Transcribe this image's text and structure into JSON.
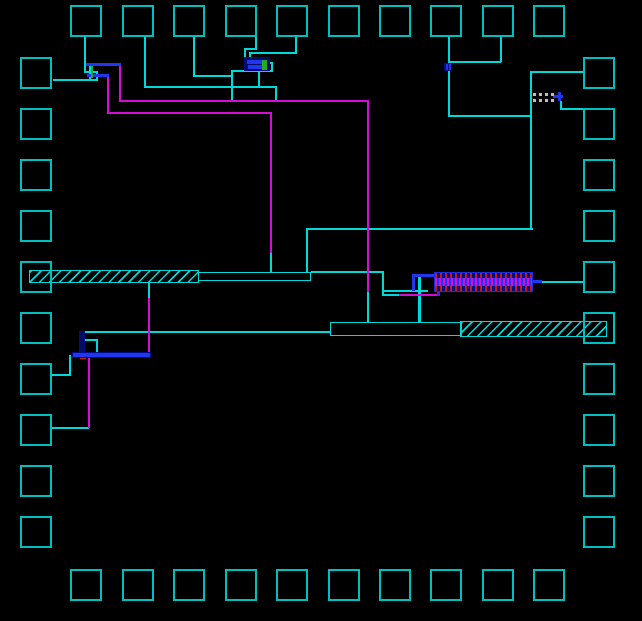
{
  "app": {
    "title": "ic-layout-canvas"
  },
  "canvas": {
    "width": 642,
    "height": 621,
    "bg": "#000000"
  },
  "layers": {
    "metal1": "#00d9d9",
    "metal2": "#2136f0",
    "metal2_dark": "#000d85",
    "metal3": "#d40ed4",
    "poly": "#1fae1f",
    "contact": "#cc1616",
    "resistor": "#bdbdbd",
    "pad": "#00bfbf",
    "comb_border": "#1b2ae0",
    "device_fill": "#000d66"
  },
  "pads": {
    "size": 32,
    "border": 2,
    "top": {
      "y": 5,
      "xs": [
        70,
        122,
        173,
        225,
        276,
        328,
        379,
        430,
        482,
        533
      ]
    },
    "bottom": {
      "y": 569,
      "xs": [
        70,
        122,
        173,
        225,
        276,
        328,
        379,
        430,
        482,
        533
      ]
    },
    "left": {
      "x": 20,
      "ys": [
        57,
        108,
        159,
        210,
        261,
        312,
        363,
        414,
        465,
        516
      ]
    },
    "right": {
      "x": 583,
      "ys": [
        57,
        108,
        159,
        210,
        261,
        312,
        363,
        414,
        465,
        516
      ]
    }
  },
  "wires": [
    [
      "m1",
      84,
      37,
      2,
      36
    ],
    [
      "m1",
      85,
      71,
      12,
      2
    ],
    [
      "m1",
      96,
      71,
      2,
      10
    ],
    [
      "m1",
      53,
      79,
      45,
      2
    ],
    [
      "m1",
      89,
      64,
      2,
      17
    ],
    [
      "m1",
      144,
      37,
      2,
      51
    ],
    [
      "m1",
      144,
      86,
      133,
      2
    ],
    [
      "m1",
      275,
      86,
      2,
      16
    ],
    [
      "m1",
      193,
      37,
      2,
      40
    ],
    [
      "m1",
      193,
      75,
      40,
      2
    ],
    [
      "m1",
      231,
      70,
      2,
      32
    ],
    [
      "m1",
      231,
      70,
      42,
      2
    ],
    [
      "m1",
      258,
      70,
      2,
      17
    ],
    [
      "m1",
      271,
      62,
      2,
      9
    ],
    [
      "m1",
      268,
      62,
      5,
      2
    ],
    [
      "m1",
      255,
      37,
      2,
      13
    ],
    [
      "m1",
      244,
      48,
      13,
      2
    ],
    [
      "m1",
      244,
      48,
      2,
      11
    ],
    [
      "m1",
      295,
      37,
      2,
      17
    ],
    [
      "m1",
      249,
      52,
      48,
      2
    ],
    [
      "m1",
      249,
      52,
      2,
      7
    ],
    [
      "m1",
      270,
      252,
      2,
      21
    ],
    [
      "m1",
      306,
      228,
      2,
      45
    ],
    [
      "m1",
      306,
      228,
      227,
      2
    ],
    [
      "m1",
      530,
      71,
      2,
      158
    ],
    [
      "m1",
      532,
      71,
      52,
      2
    ],
    [
      "m1",
      448,
      37,
      2,
      27
    ],
    [
      "m1",
      448,
      71,
      2,
      45
    ],
    [
      "m1",
      448,
      61,
      53,
      2
    ],
    [
      "m1",
      500,
      37,
      2,
      25
    ],
    [
      "m1",
      448,
      115,
      83,
      2
    ],
    [
      "m1",
      560,
      101,
      2,
      8
    ],
    [
      "m1",
      560,
      108,
      24,
      2
    ],
    [
      "m1",
      540,
      281,
      44,
      2
    ],
    [
      "m1",
      311,
      271,
      72,
      2
    ],
    [
      "m1",
      382,
      271,
      2,
      25
    ],
    [
      "m1",
      382,
      290,
      46,
      2
    ],
    [
      "m1",
      382,
      294,
      18,
      2
    ],
    [
      "m1",
      418,
      277,
      3,
      47
    ],
    [
      "m1",
      81,
      331,
      249,
      2
    ],
    [
      "m1",
      81,
      339,
      17,
      2
    ],
    [
      "m1",
      96,
      339,
      2,
      16
    ],
    [
      "m1",
      69,
      355,
      2,
      21
    ],
    [
      "m1",
      52,
      374,
      18,
      2
    ],
    [
      "m1",
      52,
      427,
      37,
      2
    ],
    [
      "m1",
      148,
      283,
      2,
      17
    ],
    [
      "m1",
      367,
      291,
      2,
      33
    ],
    [
      "m3",
      119,
      100,
      250,
      2
    ],
    [
      "m3",
      119,
      66,
      2,
      35
    ],
    [
      "m3",
      107,
      112,
      165,
      2
    ],
    [
      "m3",
      107,
      77,
      2,
      36
    ],
    [
      "m3",
      270,
      112,
      2,
      141
    ],
    [
      "m3",
      367,
      100,
      2,
      192
    ],
    [
      "m3",
      148,
      298,
      2,
      57
    ],
    [
      "m3",
      88,
      357,
      2,
      71
    ],
    [
      "m3",
      399,
      294,
      40,
      2
    ],
    [
      "m2",
      86,
      63,
      35,
      3
    ],
    [
      "m2",
      87,
      74,
      22,
      3
    ],
    [
      "m2",
      412,
      274,
      26,
      3
    ],
    [
      "m2",
      412,
      274,
      3,
      17
    ],
    [
      "m2",
      437,
      289,
      3,
      7
    ],
    [
      "m2",
      530,
      280,
      12,
      3
    ],
    [
      "m2",
      553,
      95,
      10,
      3
    ],
    [
      "m2",
      558,
      92,
      3,
      9
    ],
    [
      "poly",
      91,
      66,
      2,
      12
    ],
    [
      "poly",
      81,
      340,
      2,
      14
    ]
  ],
  "components": {
    "bar1_hatched": {
      "x": 29,
      "y": 270,
      "w": 170,
      "h": 13
    },
    "bar1_box": {
      "x": 198,
      "y": 272,
      "w": 113,
      "h": 9
    },
    "bar2_box": {
      "x": 330,
      "y": 322,
      "w": 132,
      "h": 14
    },
    "bar2_hatched": {
      "x": 460,
      "y": 321,
      "w": 147,
      "h": 16
    },
    "comb": {
      "x": 434,
      "y": 272,
      "w": 99,
      "h": 20,
      "rail_h": 5
    },
    "poly_resistor": {
      "x": 533,
      "y": 93,
      "w": 24,
      "row_h": 3,
      "gap": 3
    },
    "device": {
      "x": 244,
      "y": 57,
      "w": 26,
      "h": 14,
      "bars": [
        [
          2,
          2,
          20,
          4
        ],
        [
          3,
          7,
          17,
          4
        ]
      ],
      "green": [
        17,
        2,
        5,
        10
      ]
    },
    "via": {
      "x": 444,
      "y": 63,
      "w": 8,
      "h": 8
    },
    "stack": {
      "vbar": [
        79,
        331,
        6,
        25
      ],
      "contact": [
        80,
        353,
        6,
        6
      ],
      "hbar": [
        72,
        352,
        79,
        6
      ]
    }
  }
}
